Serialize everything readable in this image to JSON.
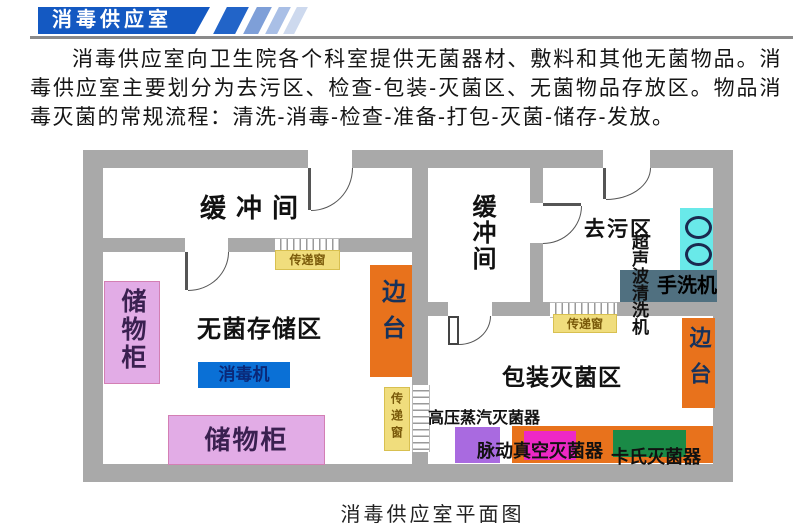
{
  "banner": {
    "title": "消毒供应室"
  },
  "intro": {
    "text": "消毒供应室向卫生院各个科室提供无菌器材、敷料和其他无菌物品。消毒供应室主要划分为去污区、检查-包装-灭菌区、无菌物品存放区。物品消毒灭菌的常规流程：清洗-消毒-检查-准备-打包-灭菌-储存-发放。"
  },
  "caption": {
    "text": "消毒供应室平面图"
  },
  "plan": {
    "rooms": {
      "buffer_left": "缓冲间",
      "buffer_mid": "缓冲间",
      "decontamination": "去污区",
      "sterile_storage": "无菌存储区",
      "packaging_sterilization": "包装灭菌区"
    },
    "furniture": {
      "cabinet_left": "储物柜",
      "cabinet_bottom": "储物柜",
      "disinfector": "消毒机",
      "side_table_left": "边台",
      "side_table_right": "边台",
      "hand_washer": "手洗机",
      "ultrasonic_cleaner": "超声波清洗机",
      "autoclave": "高压蒸汽灭菌器",
      "pulse_vacuum_sterilizer": "脉动真空灭菌器",
      "cassette_sterilizer": "卡氏灭菌器",
      "pass_window_left": "传递窗",
      "pass_window_mid": "传递窗",
      "pass_window_right": "传递窗"
    }
  },
  "colors": {
    "banner_blue": "#1459c2",
    "wall_gray": "#a9a9a9",
    "orange": "#e8721c",
    "pink": "#e2ace6",
    "yellow": "#f0dd7d",
    "cyan": "#69e9e9",
    "blue": "#0a70d6",
    "purple": "#a96ae0",
    "magenta": "#ee28c6",
    "green": "#1a8a46",
    "slate_gray": "#507080"
  }
}
